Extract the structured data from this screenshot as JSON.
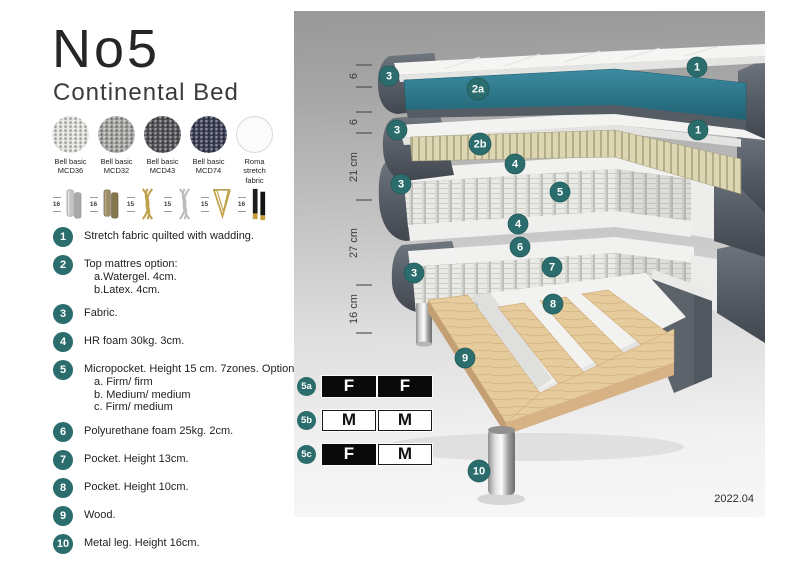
{
  "header": {
    "title": "No5",
    "subtitle": "Continental Bed"
  },
  "swatches": [
    {
      "line1": "Bell basic",
      "line2": "MCD36",
      "color": "#e4e3df"
    },
    {
      "line1": "Bell basic",
      "line2": "MCD32",
      "color": "#a9a9a7"
    },
    {
      "line1": "Bell basic",
      "line2": "MCD43",
      "color": "#55565a"
    },
    {
      "line1": "Bell basic",
      "line2": "MCD74",
      "color": "#3d4157"
    },
    {
      "line1": "Roma",
      "line2": "stretch fabric",
      "color": "#fbfbfb"
    }
  ],
  "legs": [
    {
      "size": "16",
      "icon": "cylinder-silver-legs"
    },
    {
      "size": "16",
      "icon": "cylinder-wood-legs"
    },
    {
      "size": "15",
      "icon": "twisted-gold-legs"
    },
    {
      "size": "15",
      "icon": "twisted-silver-legs"
    },
    {
      "size": "15",
      "icon": "hairpin-gold-leg"
    },
    {
      "size": "16",
      "icon": "black-gold-legs"
    }
  ],
  "list": [
    {
      "num": "1",
      "text": "Stretch fabric quilted with wadding."
    },
    {
      "num": "2",
      "text": "Top mattres option:",
      "subs": [
        "a.Watergel. 4cm.",
        "b.Latex. 4cm."
      ]
    },
    {
      "num": "3",
      "text": "Fabric."
    },
    {
      "num": "4",
      "text": "HR foam 30kg. 3cm."
    },
    {
      "num": "5",
      "text": "Micropocket. Height 15 cm. 7zones. Option:",
      "subs": [
        "a. Firm/ firm",
        "b. Medium/ medium",
        "c. Firm/ medium"
      ]
    },
    {
      "num": "6",
      "text": "Polyurethane foam 25kg. 2cm."
    },
    {
      "num": "7",
      "text": "Pocket. Height 13cm."
    },
    {
      "num": "8",
      "text": "Pocket. Height 10cm."
    },
    {
      "num": "9",
      "text": "Wood."
    },
    {
      "num": "10",
      "text": "Metal leg. Height 16cm."
    }
  ],
  "diagram": {
    "ruler": [
      "6",
      "6",
      "21 cm",
      "27 cm",
      "16 cm"
    ],
    "badges": [
      "1",
      "3",
      "2a",
      "1",
      "3",
      "2b",
      "4",
      "3",
      "5",
      "4",
      "6",
      "3",
      "7",
      "8",
      "9",
      "10"
    ],
    "version": "2022.04"
  },
  "firmness": {
    "rows": [
      {
        "id": "5a",
        "cells": [
          "F",
          "F"
        ]
      },
      {
        "id": "5b",
        "cells": [
          "M",
          "M"
        ]
      },
      {
        "id": "5c",
        "cells": [
          "F",
          "M"
        ]
      }
    ]
  },
  "colors": {
    "badge_teal": "#2b6d6c",
    "watergel_teal": "#2d7e91",
    "dark_fabric": "#575d66",
    "latex": "#dcd6b2",
    "wood": "#e6cb9d",
    "metal": "#c9c9c9"
  }
}
